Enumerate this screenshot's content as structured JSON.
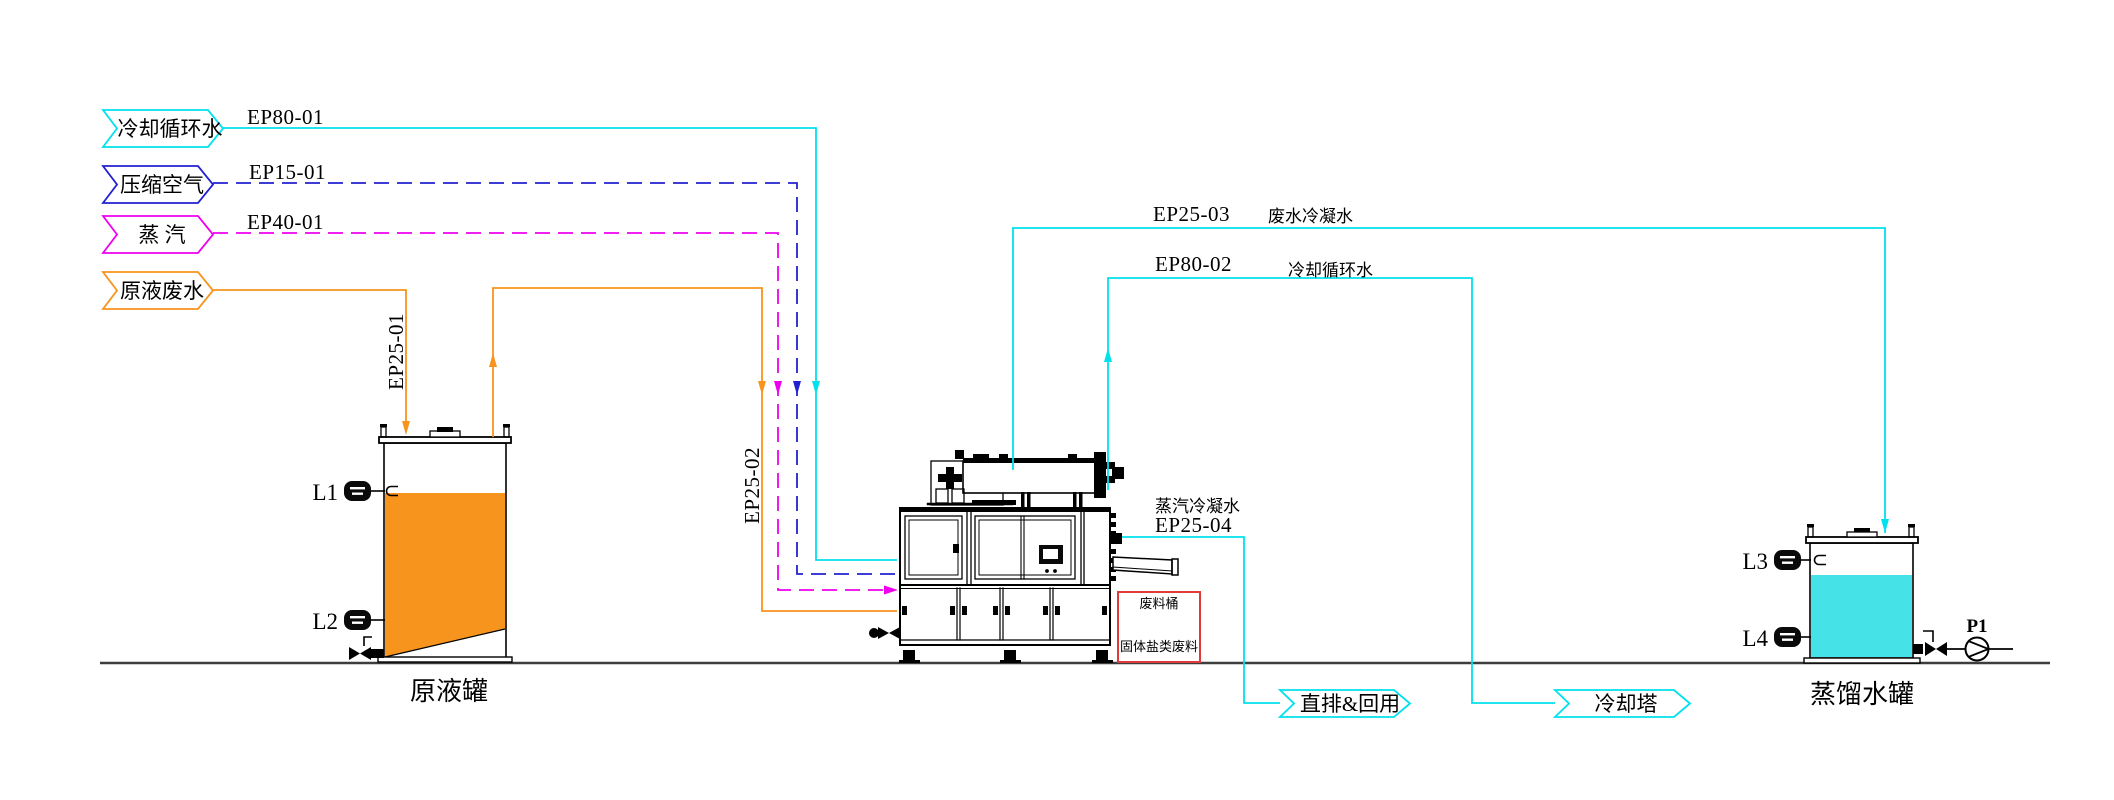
{
  "flags": {
    "cooling_water": {
      "label": "冷却循环水"
    },
    "compressed_air": {
      "label": "压缩空气"
    },
    "steam": {
      "label": "蒸 汽"
    },
    "raw_wastewater": {
      "label": "原液废水"
    },
    "discharge_reuse": {
      "label": "直排&回用"
    },
    "cooling_tower": {
      "label": "冷却塔"
    }
  },
  "pipes": {
    "ep80_01": {
      "code": "EP80-01"
    },
    "ep15_01": {
      "code": "EP15-01"
    },
    "ep40_01": {
      "code": "EP40-01"
    },
    "ep25_01": {
      "code": "EP25-01"
    },
    "ep25_02": {
      "code": "EP25-02"
    },
    "ep25_03": {
      "code": "EP25-03",
      "stream": "废水冷凝水"
    },
    "ep80_02": {
      "code": "EP80-02",
      "stream": "冷却循环水"
    },
    "ep25_04": {
      "code": "EP25-04",
      "stream": "蒸汽冷凝水"
    }
  },
  "equipment": {
    "raw_tank": {
      "label": "原液罐",
      "level_high": "L1",
      "level_low": "L2"
    },
    "distilled_tank": {
      "label": "蒸馏水罐",
      "level_high": "L3",
      "level_low": "L4"
    },
    "pump": {
      "tag": "P1"
    },
    "waste_box": {
      "title": "废料桶",
      "note": "固体盐类废料"
    }
  },
  "colors": {
    "cooling_water": "#00E1EC",
    "compressed_air": "#2222CF",
    "steam": "#EE00EE",
    "wastewater": "#F7941D",
    "raw_tank_fill": "#F7941D",
    "distilled_tank_fill": "#45E2E8",
    "waste_box_border": "#E03A3A",
    "waste_box_text": "#F7941D",
    "ground": "#3D3D3D"
  }
}
